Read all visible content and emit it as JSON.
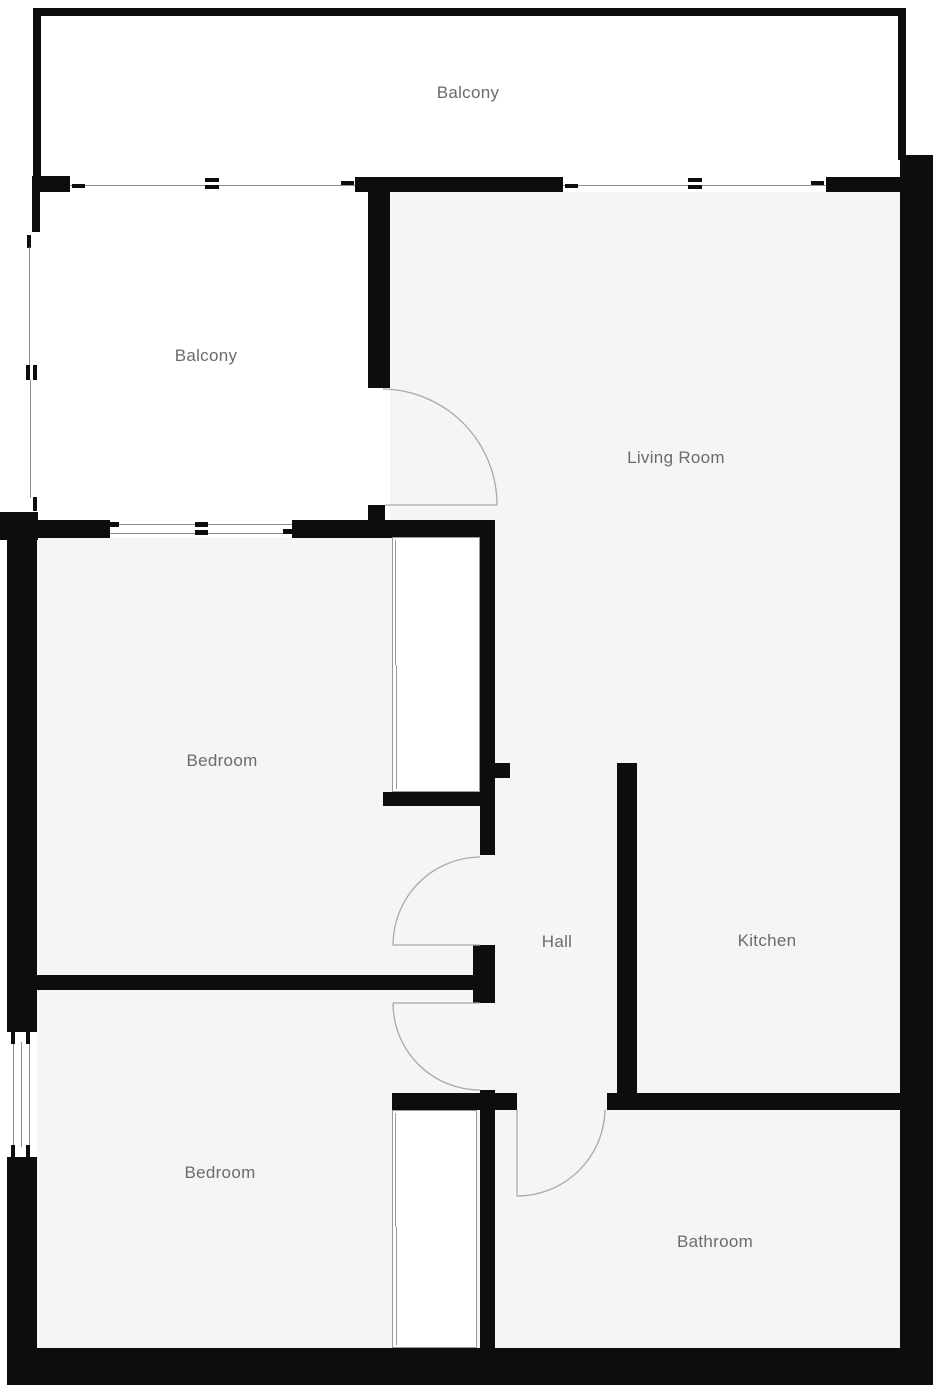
{
  "plan": {
    "title": "Apartment floor plan",
    "rooms": [
      {
        "id": "balcony-top",
        "label": "Balcony"
      },
      {
        "id": "balcony-left",
        "label": "Balcony"
      },
      {
        "id": "living-room",
        "label": "Living Room"
      },
      {
        "id": "bedroom-upper",
        "label": "Bedroom"
      },
      {
        "id": "hall",
        "label": "Hall"
      },
      {
        "id": "kitchen",
        "label": "Kitchen"
      },
      {
        "id": "bedroom-lower",
        "label": "Bedroom"
      },
      {
        "id": "bathroom",
        "label": "Bathroom"
      }
    ],
    "colors": {
      "wall": "#0d0d0d",
      "floor": "#f5f5f5",
      "balcony_floor": "#ffffff",
      "label": "#6b6b6b",
      "door_arc": "#a9a9a9",
      "window_line": "#8f8f8f"
    }
  }
}
